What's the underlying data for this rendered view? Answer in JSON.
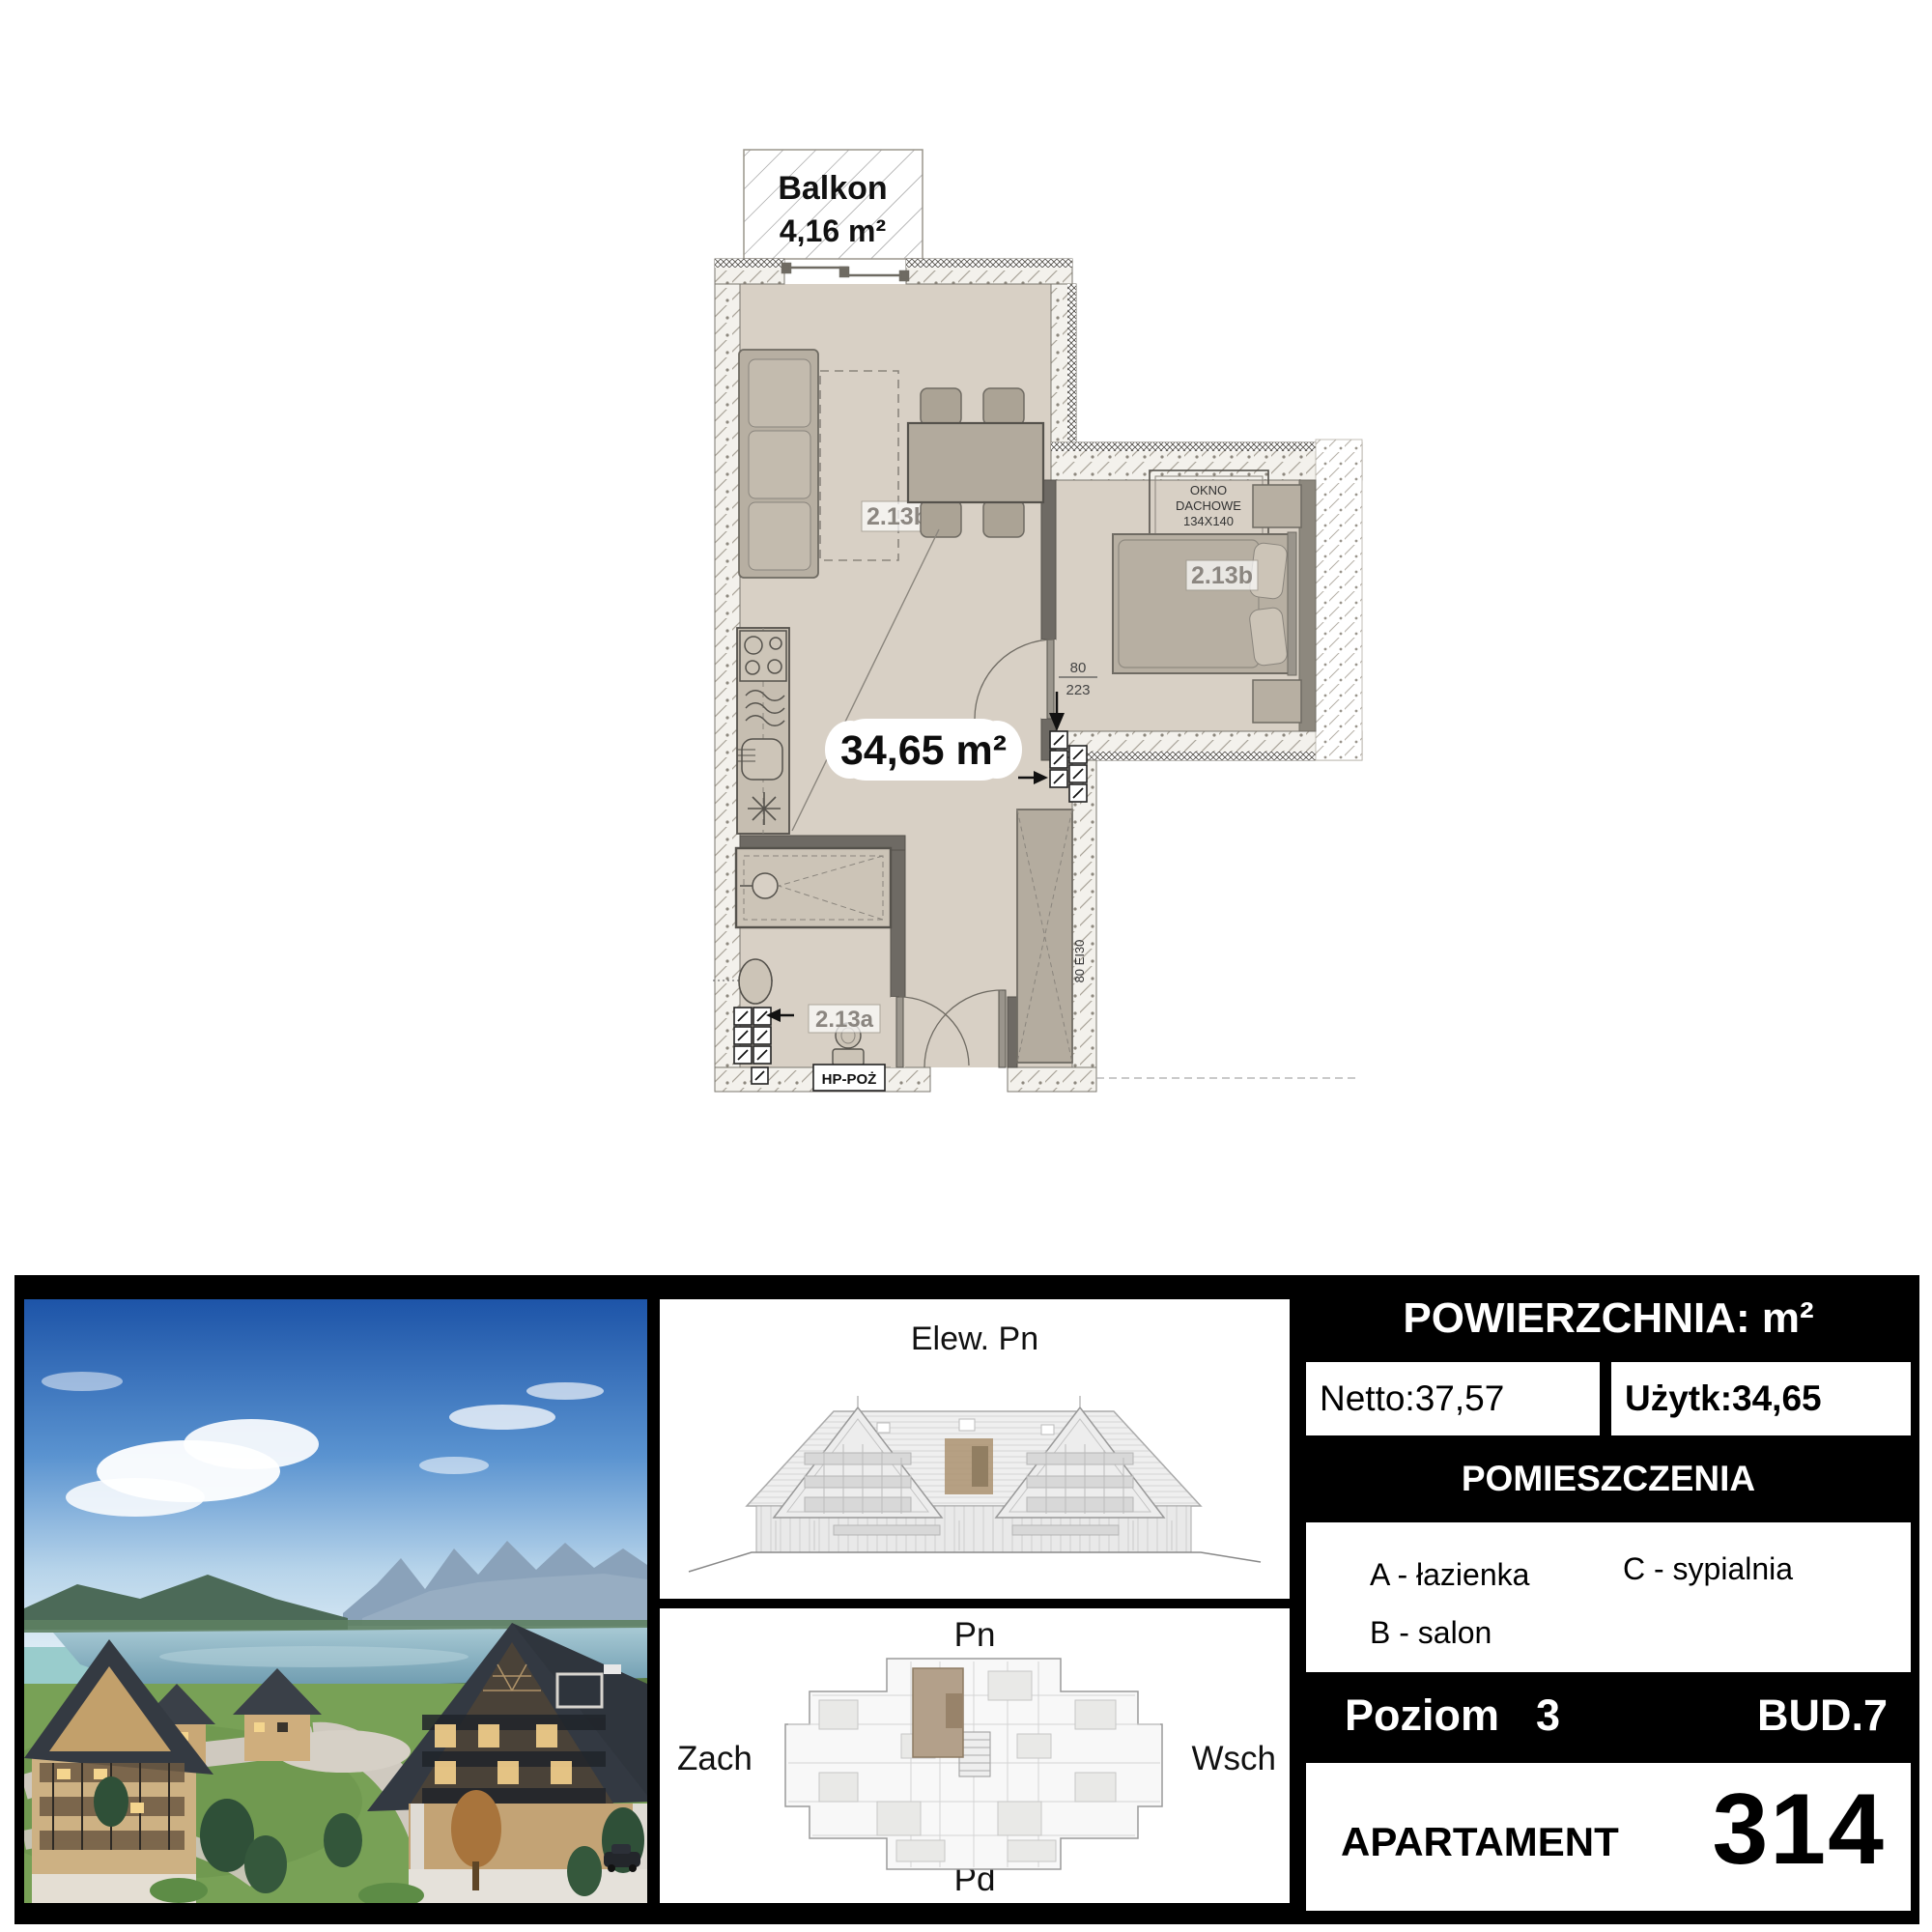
{
  "floor_plan": {
    "balcony_label": "Balkon",
    "balcony_area": "4,16 m²",
    "apartment_area": "34,65 m²",
    "living_room_code": "2.13b",
    "bedroom_code": "2.13b",
    "bathroom_code": "2.13a",
    "skylight": {
      "line1": "OKNO",
      "line2": "DACHOWE",
      "line3": "134X140"
    },
    "door_width": "80",
    "door_height": "223",
    "hydrant_label": "HP-POŻ",
    "fire_door_label": "80 EI30"
  },
  "elevation_panel": {
    "title": "Elew. Pn"
  },
  "site_panel": {
    "north": "Pn",
    "south": "Pd",
    "west": "Zach",
    "east": "Wsch"
  },
  "info_panel": {
    "area_header": "POWIERZCHNIA: m²",
    "netto_label": "Netto:",
    "netto_value": "37,57",
    "uzytk_label": "Użytk:",
    "uzytk_value": "34,65",
    "rooms_header": "POMIESZCZENIA",
    "room_a": "A - łazienka",
    "room_b": "B - salon",
    "room_c": "C - sypialnia",
    "level_label": "Poziom",
    "level_value": "3",
    "building": "BUD.7",
    "apartment_label": "APARTAMENT",
    "apartment_number": "314"
  },
  "colors": {
    "floor": "#d8d0c5",
    "furniture": "#b7afa2",
    "wall_solid": "#6e6a64",
    "unit_highlight": "#b3a08a",
    "panel_background": "#000000"
  }
}
